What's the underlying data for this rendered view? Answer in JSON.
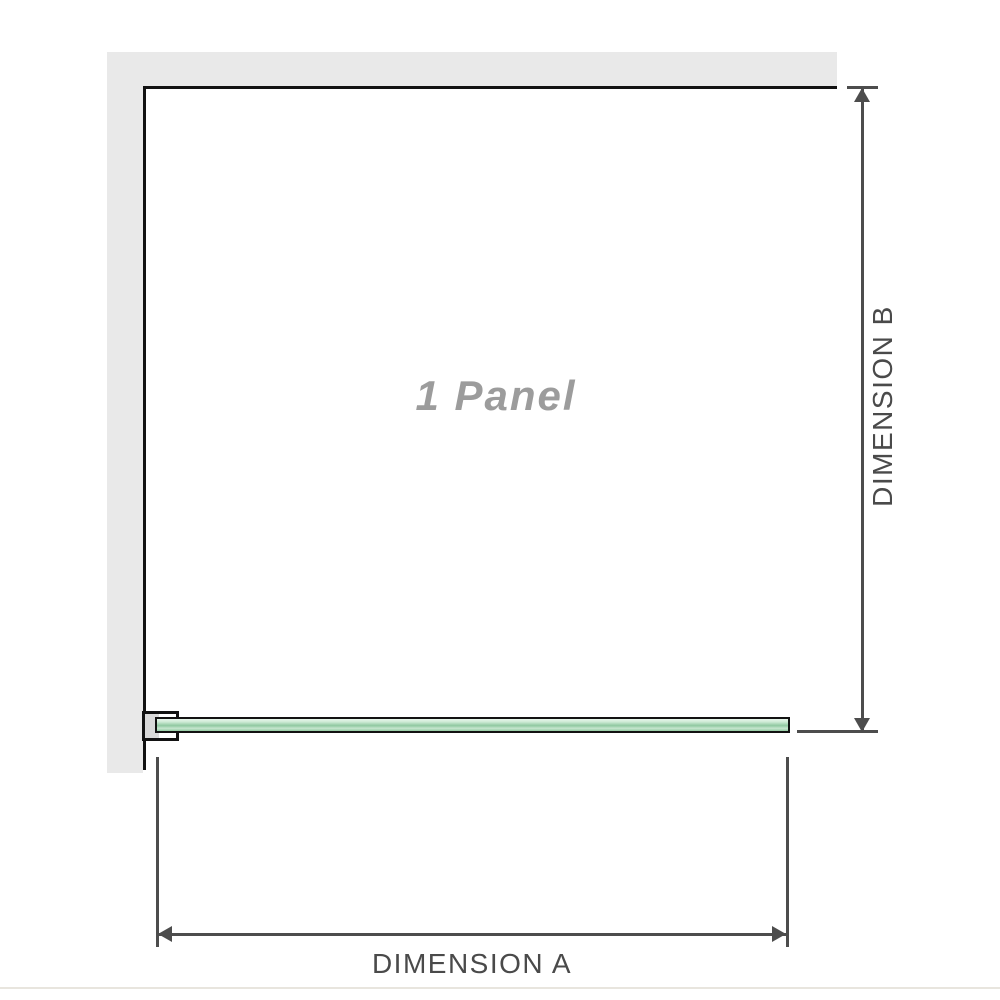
{
  "diagram": {
    "panel_label": "1 Panel",
    "dimension_a_label": "DIMENSION A",
    "dimension_b_label": "DIMENSION B"
  },
  "icons": {
    "dim_b_arrow_up": "triangle-up",
    "dim_b_arrow_down": "triangle-down",
    "dim_a_arrow_left": "triangle-left",
    "dim_a_arrow_right": "triangle-right"
  },
  "colors": {
    "wall_fill": "#e9e9e9",
    "outline": "#121212",
    "dimension_line": "#4d4d4d",
    "label_text": "#4a4a4a",
    "panel_label_text": "#9c9c9c",
    "glass_green_light": "#e9f6ec",
    "glass_green_mid": "#8fc8a0",
    "bracket_pad": "#d9d9d9",
    "page_edge_line": "#e8e5de"
  }
}
